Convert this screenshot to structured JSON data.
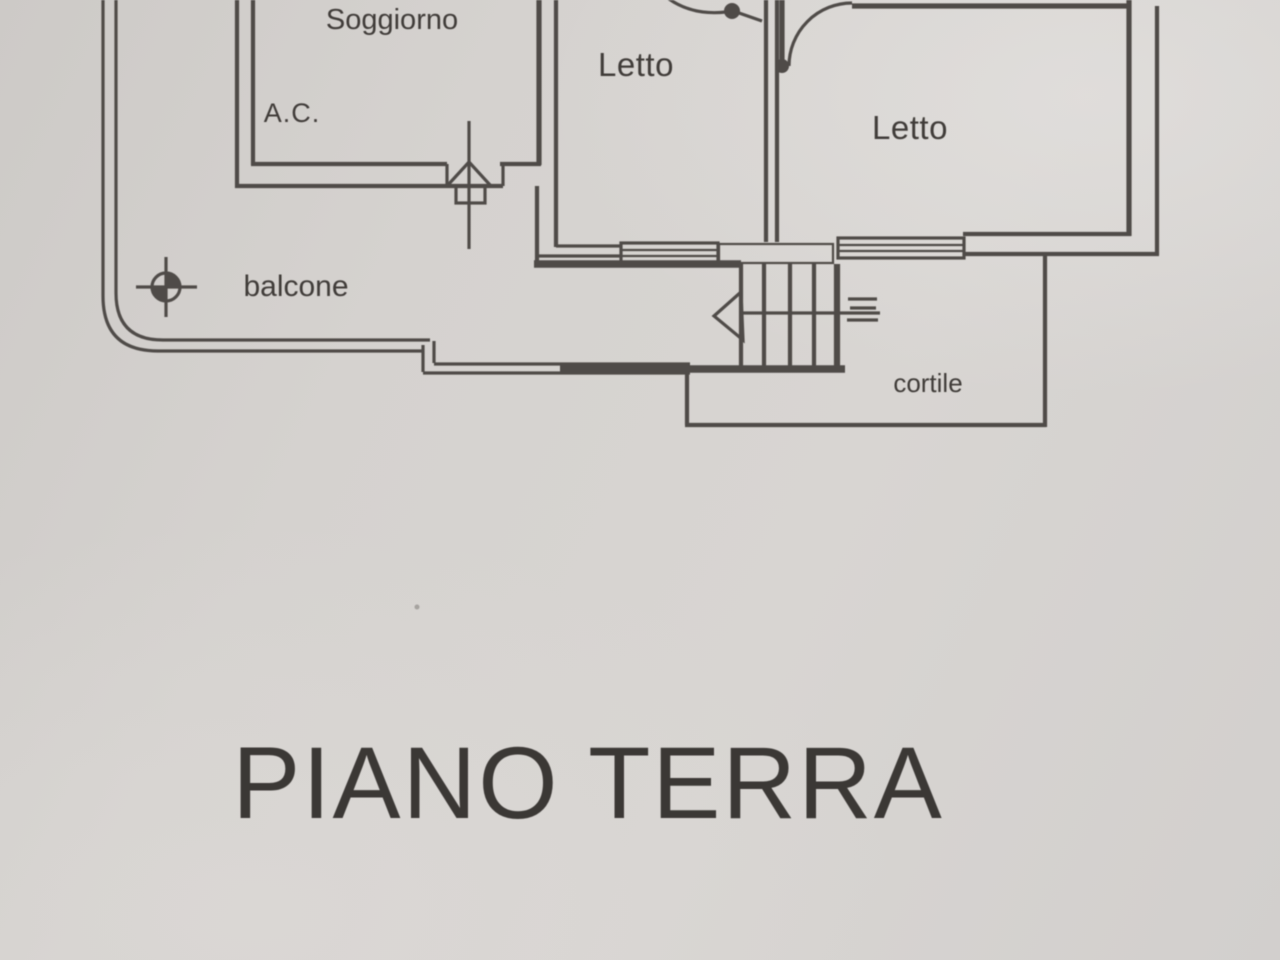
{
  "plan": {
    "title": "PIANO TERRA",
    "rooms": {
      "soggiorno": "Soggiorno",
      "ac": "A.C.",
      "letto1": "Letto",
      "letto2": "Letto",
      "balcone": "balcone",
      "cortile": "cortile"
    },
    "colors": {
      "paper": "#d5d2cf",
      "ink": "#4f4b48",
      "text": "#3b3835"
    }
  }
}
